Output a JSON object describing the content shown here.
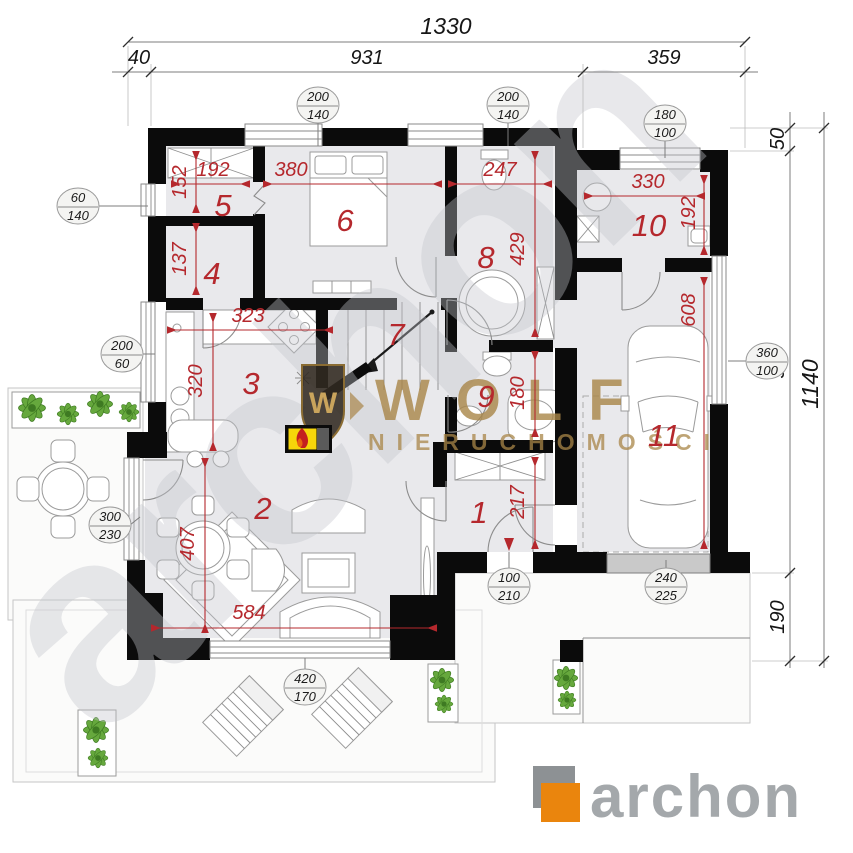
{
  "top_dims": {
    "total": "1330",
    "seg_left": "40",
    "seg_mid": "931",
    "seg_right": "359"
  },
  "right_dims": {
    "outer": "1140",
    "top": "50",
    "mid": "900",
    "bottom": "190"
  },
  "rooms": [
    {
      "n": "1"
    },
    {
      "n": "2"
    },
    {
      "n": "3"
    },
    {
      "n": "4"
    },
    {
      "n": "5"
    },
    {
      "n": "6"
    },
    {
      "n": "7"
    },
    {
      "n": "8"
    },
    {
      "n": "9"
    },
    {
      "n": "10"
    },
    {
      "n": "11"
    }
  ],
  "red_dims": [
    {
      "v": "192"
    },
    {
      "v": "152"
    },
    {
      "v": "380"
    },
    {
      "v": "247"
    },
    {
      "v": "137"
    },
    {
      "v": "323"
    },
    {
      "v": "320"
    },
    {
      "v": "429"
    },
    {
      "v": "330"
    },
    {
      "v": "192"
    },
    {
      "v": "608"
    },
    {
      "v": "180"
    },
    {
      "v": "217"
    },
    {
      "v": "407"
    },
    {
      "v": "584"
    }
  ],
  "window_markers": [
    {
      "w": "200",
      "h": "140"
    },
    {
      "w": "200",
      "h": "140"
    },
    {
      "w": "180",
      "h": "100"
    },
    {
      "w": "60",
      "h": "140"
    },
    {
      "w": "200",
      "h": "60"
    },
    {
      "w": "300",
      "h": "230"
    },
    {
      "w": "100",
      "h": "210"
    },
    {
      "w": "240",
      "h": "225"
    },
    {
      "w": "420",
      "h": "170"
    },
    {
      "w": "360",
      "h": "100"
    }
  ],
  "watermark": {
    "monogram": "W",
    "brand": "WOLF",
    "subtitle": "NIERUCHOMOŚCI",
    "diagonal": "archon"
  },
  "logo": {
    "text": "archon"
  },
  "colors": {
    "dim_red": "#b5282d",
    "wall": "#0b0b0b",
    "floor": "#e9e9ec",
    "gold": "#a98648",
    "logo_orange": "#ea850d",
    "logo_gray": "#a4a8ab",
    "plant_green": "#66a83d",
    "fireplace_yellow": "#f6d60a"
  }
}
